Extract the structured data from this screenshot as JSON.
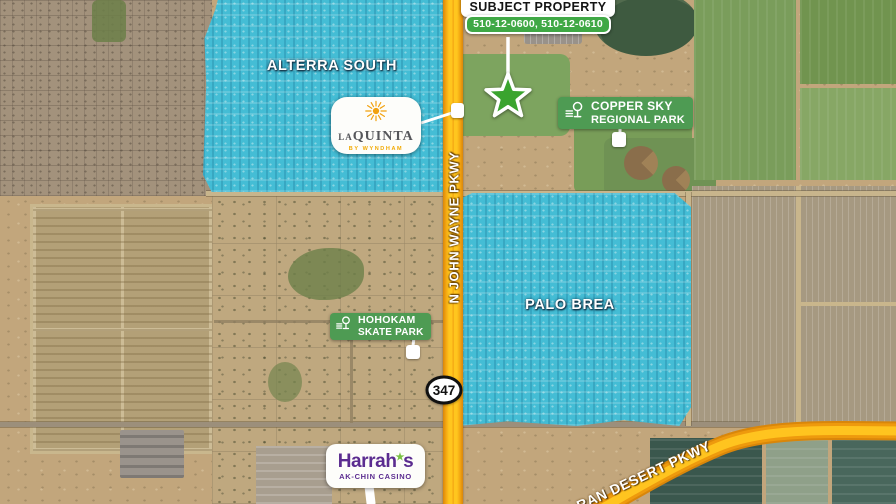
{
  "subject": {
    "title": "SUBJECT PROPERTY",
    "parcels": "510-12-0600, 510-12-0610"
  },
  "neighborhoods": {
    "alterra_south": "ALTERRA SOUTH",
    "palo_brea": "PALO BREA"
  },
  "roads": {
    "john_wayne_pkwy": "N JOHN WAYNE PKWY",
    "desert_pkwy": "RAN DESERT PKWY",
    "shield_number": "347"
  },
  "pois": {
    "laquinta": {
      "brand_la": "LA",
      "brand_quinta": "QUINTA",
      "tagline": "BY WYNDHAM"
    },
    "copper_sky": {
      "line1": "COPPER SKY",
      "line2": "REGIONAL PARK"
    },
    "hohokam": {
      "line1": "HOHOKAM",
      "line2": "SKATE PARK"
    },
    "harrahs": {
      "brand": "Harrah",
      "apostrophe_star": "★",
      "brand_suffix": "s",
      "line2": "AK-CHIN CASINO"
    }
  },
  "colors": {
    "highlight_cyan": "#3fbed9",
    "road_yellow": "#ffc61e",
    "road_orange": "#ee9a0d",
    "label_green": "#4e9b53",
    "parcel_green": "#3fa845",
    "subject_star_green": "#3aa42e",
    "harrahs_purple": "#5b2c90",
    "harrahs_star_green": "#7ac143",
    "laquinta_gold": "#f2a900",
    "laquinta_gray": "#55565a"
  }
}
